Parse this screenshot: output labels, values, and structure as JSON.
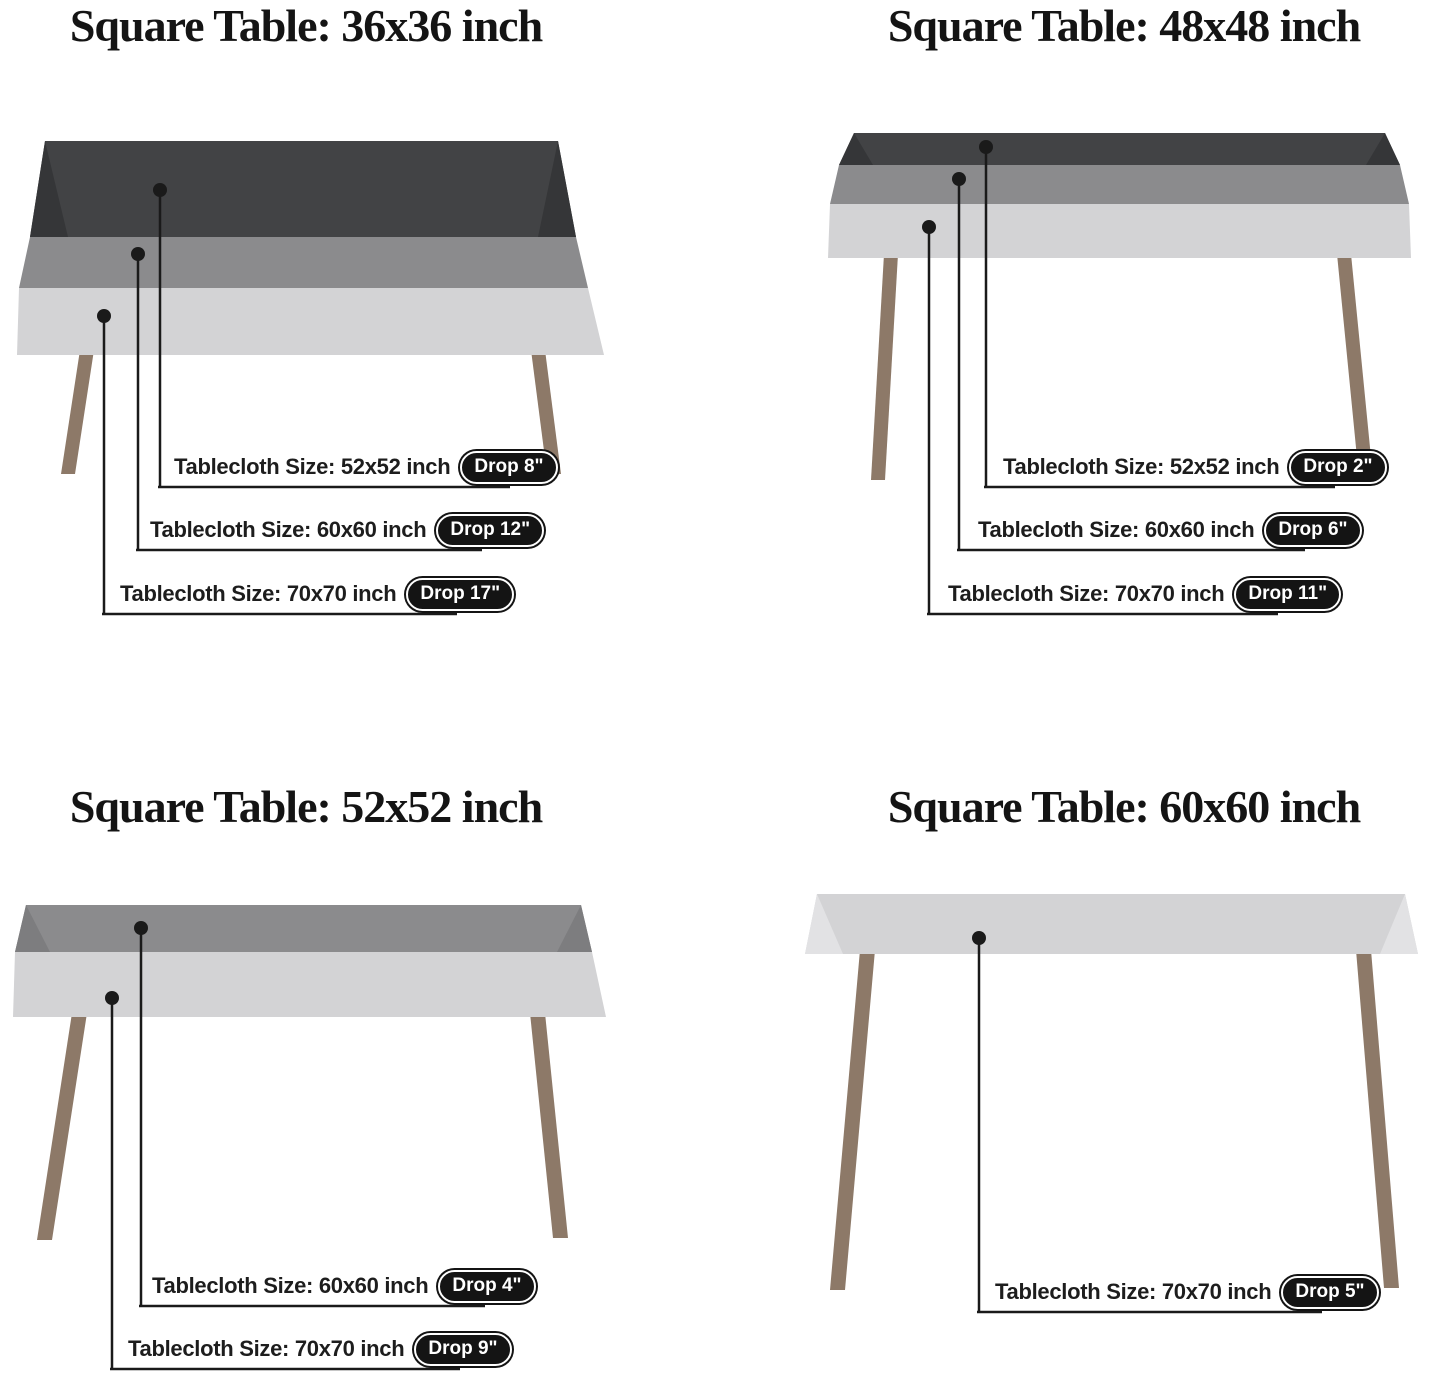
{
  "page": {
    "background": "#ffffff",
    "description": "Tablecloth size guide for square tables, 4 panels"
  },
  "colors": {
    "title": "#141414",
    "label": "#1d1d1d",
    "line": "#1a1a1a",
    "badge_bg": "#141414",
    "badge_text": "#ffffff",
    "cloth_dark": "#424345",
    "cloth_medium": "#8b8b8d",
    "cloth_light": "#d3d3d5",
    "leg": "#8d7968"
  },
  "quadrants": [
    {
      "table_size": "36x36 inch",
      "title": "Square Table: 36x36 inch",
      "callouts": [
        {
          "text": "Tablecloth Size: 52x52 inch",
          "badge": "Drop 8\""
        },
        {
          "text": "Tablecloth Size: 60x60 inch",
          "badge": "Drop 12\""
        },
        {
          "text": "Tablecloth Size: 70x70 inch",
          "badge": "Drop 17\""
        }
      ]
    },
    {
      "table_size": "48x48 inch",
      "title": "Square Table: 48x48 inch",
      "callouts": [
        {
          "text": "Tablecloth Size: 52x52 inch",
          "badge": "Drop 2\""
        },
        {
          "text": "Tablecloth Size: 60x60 inch",
          "badge": "Drop 6\""
        },
        {
          "text": "Tablecloth Size: 70x70 inch",
          "badge": "Drop 11\""
        }
      ]
    },
    {
      "table_size": "52x52 inch",
      "title": "Square Table: 52x52 inch",
      "callouts": [
        {
          "text": "Tablecloth Size: 60x60 inch",
          "badge": "Drop 4\""
        },
        {
          "text": "Tablecloth Size: 70x70 inch",
          "badge": "Drop 9\""
        }
      ]
    },
    {
      "table_size": "60x60 inch",
      "title": "Square Table: 60x60 inch",
      "callouts": [
        {
          "text": "Tablecloth Size: 70x70 inch",
          "badge": "Drop 5\""
        }
      ]
    }
  ]
}
